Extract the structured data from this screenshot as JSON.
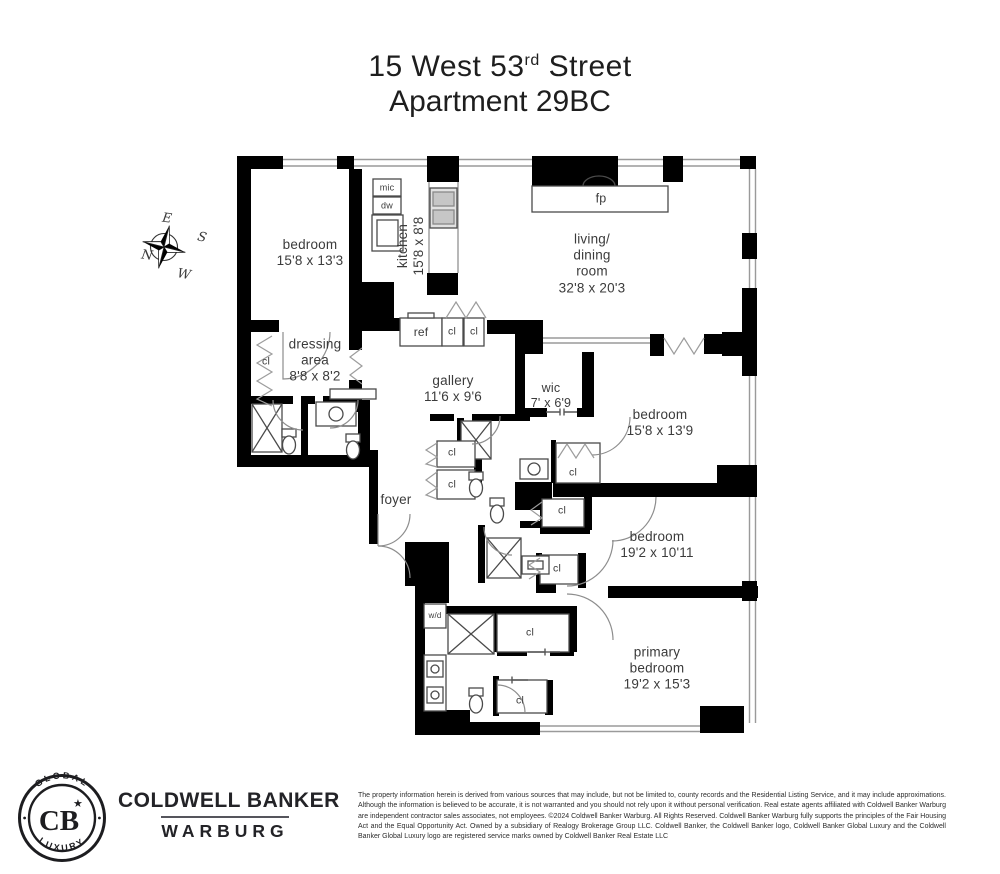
{
  "title": {
    "line1_prefix": "15 West 53",
    "line1_sup": "rd",
    "line1_suffix": " Street",
    "line2": "Apartment 29BC"
  },
  "compass": {
    "east": "E",
    "south": "S",
    "north": "N",
    "west": "W"
  },
  "rooms": {
    "bedroom1": {
      "name": "bedroom",
      "dims": "15'8 x 13'3"
    },
    "kitchen": {
      "name": "kitchen",
      "dims": "15'8 x 8'8"
    },
    "living": {
      "name": "living/\ndining\nroom",
      "dims": "32'8 x 20'3"
    },
    "dressing": {
      "name": "dressing\narea",
      "dims": "8'8 x 8'2"
    },
    "gallery": {
      "name": "gallery",
      "dims": "11'6 x 9'6"
    },
    "wic": {
      "name": "wic",
      "dims": "7' x 6'9"
    },
    "bedroom2": {
      "name": "bedroom",
      "dims": "15'8 x 13'9"
    },
    "bedroom3": {
      "name": "bedroom",
      "dims": "19'2 x 10'11"
    },
    "primary": {
      "name": "primary\nbedroom",
      "dims": "19'2 x 15'3"
    },
    "foyer": {
      "name": "foyer"
    }
  },
  "fixtures": {
    "fireplace": "fp",
    "microwave": "mic",
    "dishwasher": "dw",
    "refrigerator": "ref",
    "washer_dryer": "w/d",
    "closet": "cl"
  },
  "footer": {
    "brand_line1": "COLDWELL BANKER",
    "brand_line2": "WARBURG",
    "seal_top": "GLOBAL",
    "seal_bottom": "LUXURY",
    "seal_monogram": "CB",
    "seal_star": "★",
    "disclaimer": "The property information herein is derived from various sources that may include, but not be limited to, county records and the Residential Listing Service, and it may include approximations. Although the information is believed to be accurate, it is not warranted and you should not rely upon it without personal verification. Real estate agents affiliated with Coldwell Banker Warburg are independent contractor sales associates, not employees. ©2024 Coldwell Banker Warburg. All Rights Reserved. Coldwell Banker Warburg fully supports the principles of the Fair Housing Act and the Equal Opportunity Act. Owned by a subsidiary of Realogy Brokerage Group LLC. Coldwell Banker, the Coldwell Banker logo, Coldwell Banker Global Luxury and the Coldwell Banker Global Luxury logo are registered service marks owned by Coldwell Banker Real Estate LLC"
  },
  "colors": {
    "wall": "#000000",
    "window_line": "#9a9a9a",
    "label_text": "#3b3b3b"
  }
}
